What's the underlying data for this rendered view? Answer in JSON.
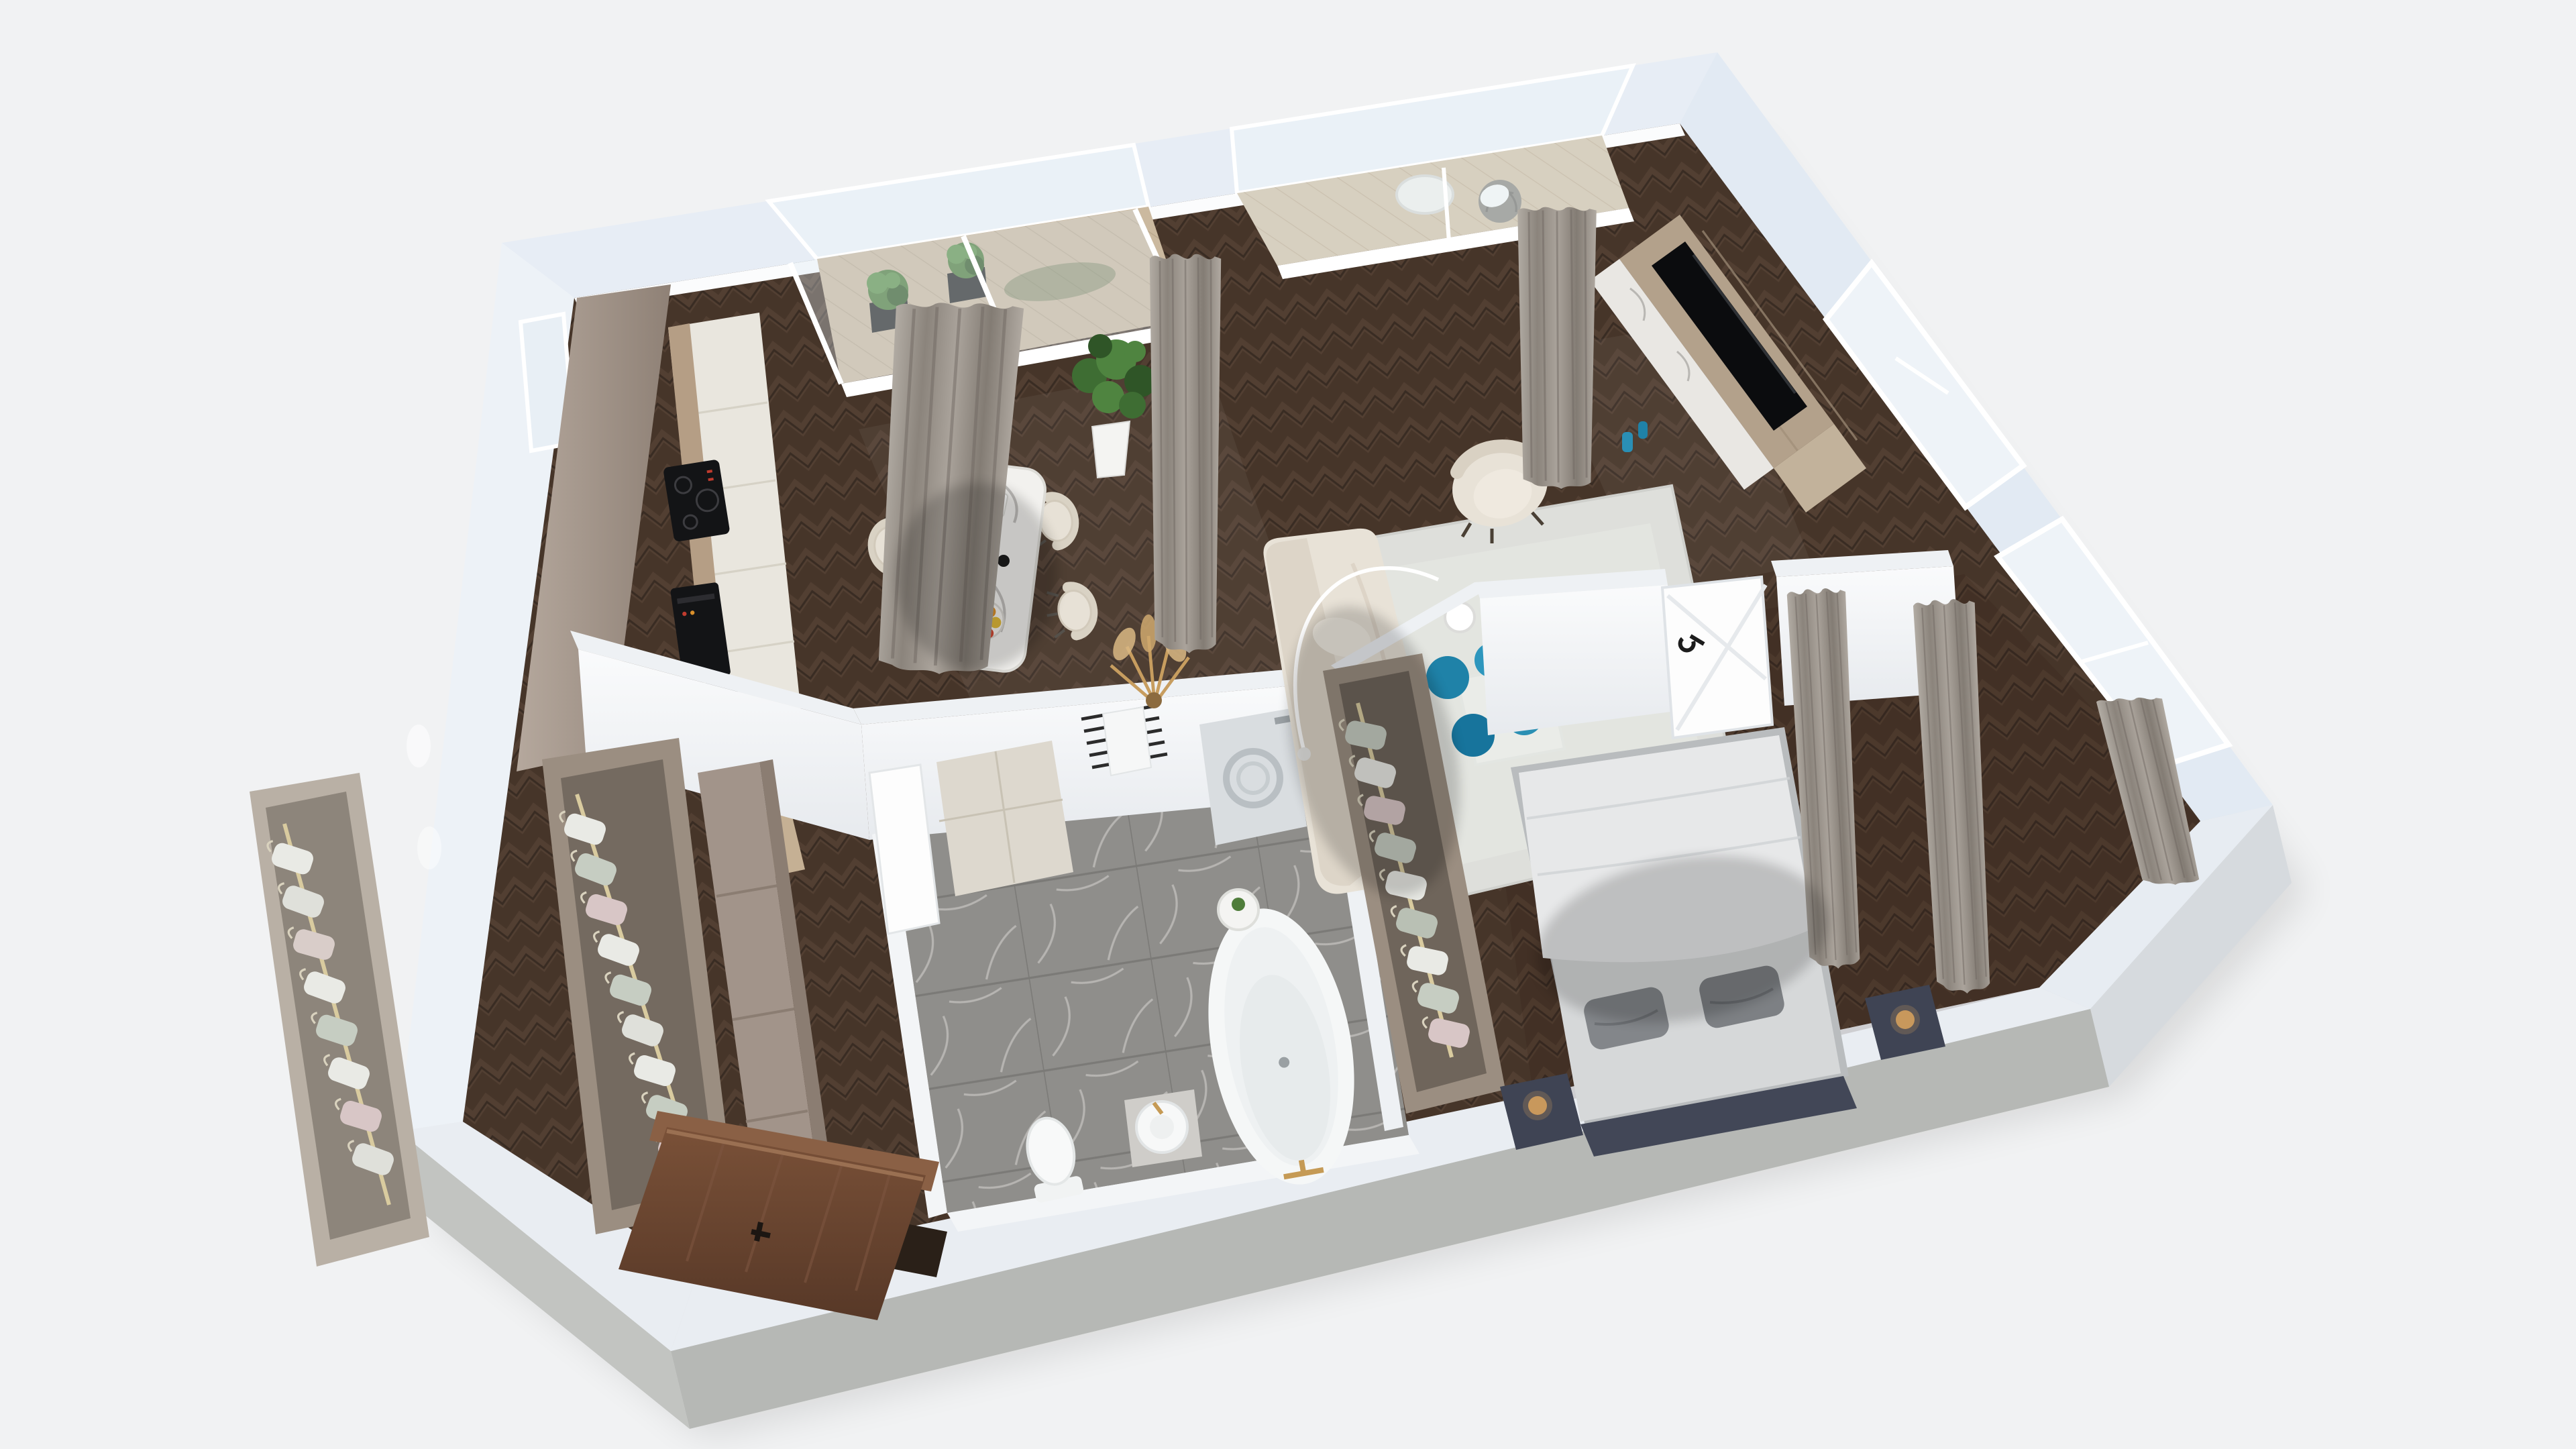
{
  "meta": {
    "type": "3d-floor-plan-render",
    "view": "isometric-top-down",
    "rooms": [
      "kitchen",
      "dining-area",
      "living-room",
      "bathroom",
      "bedroom",
      "entry-hallway",
      "kitchen-balcony",
      "living-balcony",
      "closet-racks"
    ],
    "furniture": {
      "kitchen": [
        "accent-wallpaper-wall",
        "cream-cabinet-run",
        "induction-cooktop",
        "built-in-oven",
        "open-wood-shelf"
      ],
      "dining_area": [
        "marble-dining-table",
        "dining-chair x4",
        "fiddle-leaf-fig-plant",
        "pampas-grass-decor",
        "magazine",
        "fruit-bowl",
        "plant-vase"
      ],
      "living_room": [
        "cream-sofa",
        "throw-pillows",
        "area-rug",
        "glass-coffee-table",
        "teal-stools x4",
        "coral-decor",
        "armchair",
        "arc-floor-lamp",
        "tv-wood-panel",
        "tv-screen",
        "marble-console",
        "teal-vases",
        "side-table"
      ],
      "bathroom": [
        "vanity-cabinet",
        "towel-ladder",
        "washing-machine",
        "freestanding-bathtub",
        "round-basin",
        "toilet",
        "white-door",
        "gold-faucets"
      ],
      "bedroom": [
        "double-bed",
        "duvet",
        "gray-pillows",
        "navy-headboard",
        "nightstands",
        "gold-table-lamps",
        "open-wardrobe",
        "windows",
        "curtains",
        "white-door"
      ],
      "entry_hallway": [
        "open-wardrobe-left",
        "open-wardrobe-right",
        "tall-taupe-cabinet",
        "walnut-entry-door"
      ],
      "balconies": [
        "black-planters",
        "green-shrubs",
        "round-bistro-table",
        "rattan-chair",
        "white-pillow"
      ]
    }
  },
  "palette": {
    "background": "#f1f2f3",
    "wall_top": "#e7edf5",
    "wall_top_light": "#edf2f7",
    "wall_side_dark": "#b6b8b5",
    "wall_side_mid": "#c2c4c1",
    "wall_side_right": "#d6dade",
    "inner_face": "#fbfcfd",
    "interior_wall": "#f3f5f7",
    "floor_wood": "#463529",
    "floor_wood_hi": "#5a473a",
    "floor_wood_lo": "#2f231c",
    "marble_base": "#8f8e8b",
    "marble_vein": "#c6c5c2",
    "plank": "#cbb99f",
    "plank_light": "#d6c6ad",
    "glass": "#dce8f0",
    "frame_white": "#ffffff",
    "accent_wall": "#ab9d92",
    "cabinet_cream": "#e9e6de",
    "cabinet_line": "#d6d2c6",
    "counter_wood": "#b59e85",
    "appliance_black": "#131416",
    "curtain_light": "#b2aca4",
    "curtain_dark": "#837c74",
    "sofa_cream": "#e8e2d7",
    "sofa_shade": "#d9d1c3",
    "rug": "#dedfdb",
    "rug_border": "#cfd0cc",
    "teal": "#1f82a8",
    "teal_light": "#2d96bd",
    "tv_black": "#0b0c0e",
    "tv_wood": "#b3a18b",
    "marble_white": "#e9e7e3",
    "bed_sheet": "#d6d8d9",
    "bed_duvet": "#e7e8e9",
    "pillow_gray": "#83868a",
    "navy": "#424757",
    "gold": "#c9995c",
    "clothes_sage": "#c6cdc2",
    "clothes_white": "#e9eae5",
    "clothes_pink": "#d8c6c6",
    "closet_taupe": "#9b8e81",
    "closet_dark": "#6f655b",
    "door_walnut": "#6e4833",
    "door_walnut_dark": "#57392a",
    "white_door": "#fdfdfd",
    "plant_green": "#4f7d3b",
    "plant_dark": "#375c28",
    "planter_black": "#262624",
    "pot_white": "#f4f4f2",
    "tub_white": "#f5f7f7",
    "washer": "#d9dde0",
    "toilet_white": "#f8f9f9",
    "pampas": "#c79d5f",
    "chair_cream": "#e7e1d6",
    "chair_shade": "#d9d2c4",
    "table_marble": "#f2f1ee"
  }
}
